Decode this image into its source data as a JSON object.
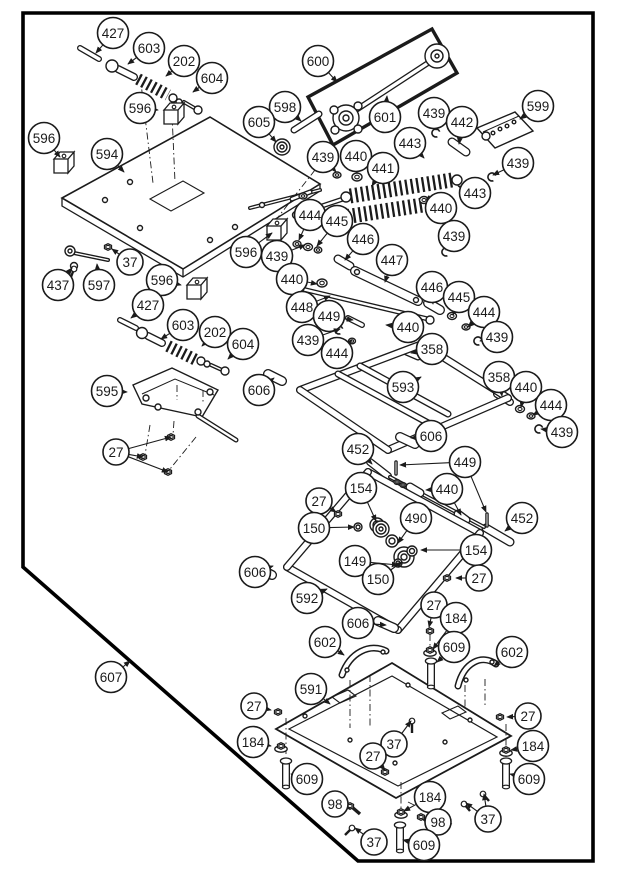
{
  "page": {
    "background": "#ffffff",
    "line_color": "#1b1b1b",
    "frame_color": "#000000"
  },
  "callouts": [
    {
      "label": "427",
      "x": 113,
      "y": 33,
      "targets": [
        [
          96,
          53
        ]
      ]
    },
    {
      "label": "603",
      "x": 149,
      "y": 48,
      "targets": [
        [
          128,
          64
        ]
      ]
    },
    {
      "label": "202",
      "x": 184,
      "y": 61,
      "targets": [
        [
          166,
          76
        ]
      ]
    },
    {
      "label": "604",
      "x": 212,
      "y": 78,
      "targets": [
        [
          193,
          92
        ]
      ]
    },
    {
      "label": "596",
      "x": 140,
      "y": 108,
      "targets": [
        [
          158,
          110
        ]
      ]
    },
    {
      "label": "598",
      "x": 285,
      "y": 107,
      "targets": [
        [
          301,
          121
        ]
      ]
    },
    {
      "label": "605",
      "x": 259,
      "y": 122,
      "targets": [
        [
          276,
          142
        ]
      ]
    },
    {
      "label": "600",
      "x": 318,
      "y": 61,
      "targets": [
        [
          337,
          82
        ]
      ]
    },
    {
      "label": "601",
      "x": 385,
      "y": 117,
      "targets": [
        [
          387,
          96
        ]
      ]
    },
    {
      "label": "439",
      "x": 434,
      "y": 113,
      "targets": [
        [
          436,
          130
        ]
      ]
    },
    {
      "label": "442",
      "x": 462,
      "y": 122,
      "targets": [
        [
          459,
          144
        ]
      ]
    },
    {
      "label": "599",
      "x": 538,
      "y": 106,
      "targets": [
        [
          520,
          119
        ]
      ]
    },
    {
      "label": "596",
      "x": 44,
      "y": 138,
      "targets": [
        [
          60,
          157
        ]
      ]
    },
    {
      "label": "594",
      "x": 107,
      "y": 154,
      "targets": [
        [
          124,
          172
        ]
      ]
    },
    {
      "label": "443",
      "x": 410,
      "y": 143,
      "targets": [
        [
          424,
          158
        ]
      ]
    },
    {
      "label": "439",
      "x": 323,
      "y": 157,
      "targets": [
        [
          336,
          172
        ]
      ]
    },
    {
      "label": "440",
      "x": 356,
      "y": 156,
      "targets": [
        [
          357,
          173
        ]
      ]
    },
    {
      "label": "441",
      "x": 383,
      "y": 168,
      "targets": [
        [
          372,
          186
        ]
      ]
    },
    {
      "label": "439",
      "x": 518,
      "y": 163,
      "targets": [
        [
          493,
          175
        ]
      ]
    },
    {
      "label": "443",
      "x": 475,
      "y": 193,
      "targets": [
        [
          458,
          186
        ]
      ]
    },
    {
      "label": "440",
      "x": 441,
      "y": 208,
      "targets": [
        [
          432,
          201
        ]
      ]
    },
    {
      "label": "444",
      "x": 310,
      "y": 215,
      "targets": [
        [
          299,
          240
        ]
      ]
    },
    {
      "label": "445",
      "x": 337,
      "y": 221,
      "targets": [
        [
          317,
          246
        ]
      ]
    },
    {
      "label": "446",
      "x": 363,
      "y": 239,
      "targets": [
        [
          345,
          260
        ]
      ]
    },
    {
      "label": "447",
      "x": 392,
      "y": 260,
      "targets": [
        [
          385,
          282
        ]
      ]
    },
    {
      "label": "439",
      "x": 454,
      "y": 236,
      "targets": [
        [
          446,
          250
        ]
      ]
    },
    {
      "label": "446",
      "x": 432,
      "y": 287,
      "targets": [
        [
          433,
          304
        ]
      ]
    },
    {
      "label": "445",
      "x": 459,
      "y": 297,
      "targets": [
        [
          453,
          315
        ]
      ]
    },
    {
      "label": "444",
      "x": 484,
      "y": 312,
      "targets": [
        [
          468,
          327
        ]
      ]
    },
    {
      "label": "439",
      "x": 497,
      "y": 337,
      "targets": [
        [
          480,
          341
        ]
      ]
    },
    {
      "label": "596",
      "x": 246,
      "y": 252,
      "targets": [
        [
          272,
          233
        ]
      ]
    },
    {
      "label": "439",
      "x": 277,
      "y": 256,
      "targets": [
        [
          305,
          245
        ]
      ]
    },
    {
      "label": "37",
      "x": 130,
      "y": 262,
      "targets": [
        [
          112,
          249
        ]
      ]
    },
    {
      "label": "437",
      "x": 58,
      "y": 285,
      "targets": [
        [
          72,
          268
        ]
      ]
    },
    {
      "label": "597",
      "x": 99,
      "y": 285,
      "targets": [
        [
          97,
          264
        ]
      ]
    },
    {
      "label": "596",
      "x": 162,
      "y": 280,
      "targets": [
        [
          181,
          285
        ]
      ]
    },
    {
      "label": "440",
      "x": 292,
      "y": 279,
      "targets": [
        [
          317,
          284
        ]
      ]
    },
    {
      "label": "448",
      "x": 302,
      "y": 307,
      "targets": [
        [
          330,
          296
        ]
      ]
    },
    {
      "label": "449",
      "x": 329,
      "y": 316,
      "targets": [
        [
          353,
          320
        ]
      ]
    },
    {
      "label": "439",
      "x": 308,
      "y": 340,
      "targets": [
        [
          340,
          329
        ]
      ]
    },
    {
      "label": "444",
      "x": 337,
      "y": 353,
      "targets": [
        [
          352,
          340
        ]
      ]
    },
    {
      "label": "440",
      "x": 408,
      "y": 327,
      "targets": [
        [
          386,
          325
        ]
      ]
    },
    {
      "label": "358",
      "x": 432,
      "y": 349,
      "targets": [
        [
          411,
          353
        ]
      ]
    },
    {
      "label": "427",
      "x": 148,
      "y": 305,
      "targets": [
        [
          131,
          318
        ]
      ]
    },
    {
      "label": "603",
      "x": 183,
      "y": 325,
      "targets": [
        [
          161,
          339
        ]
      ]
    },
    {
      "label": "202",
      "x": 215,
      "y": 332,
      "targets": [
        [
          202,
          346
        ]
      ]
    },
    {
      "label": "604",
      "x": 243,
      "y": 344,
      "targets": [
        [
          228,
          359
        ]
      ]
    },
    {
      "label": "358",
      "x": 499,
      "y": 377,
      "targets": [
        [
          502,
          396
        ]
      ]
    },
    {
      "label": "440",
      "x": 526,
      "y": 387,
      "targets": [
        [
          521,
          407
        ]
      ]
    },
    {
      "label": "444",
      "x": 551,
      "y": 405,
      "targets": [
        [
          533,
          415
        ]
      ]
    },
    {
      "label": "439",
      "x": 562,
      "y": 432,
      "targets": [
        [
          541,
          429
        ]
      ]
    },
    {
      "label": "593",
      "x": 403,
      "y": 387,
      "targets": [
        [
          421,
          377
        ]
      ]
    },
    {
      "label": "595",
      "x": 107,
      "y": 391,
      "targets": [
        [
          127,
          392
        ]
      ]
    },
    {
      "label": "606",
      "x": 259,
      "y": 390,
      "targets": [
        [
          274,
          378
        ]
      ]
    },
    {
      "label": "606",
      "x": 431,
      "y": 436,
      "targets": [
        [
          411,
          438
        ]
      ]
    },
    {
      "label": "27",
      "x": 116,
      "y": 452,
      "targets": [
        [
          171,
          437
        ],
        [
          143,
          457
        ],
        [
          168,
          472
        ]
      ]
    },
    {
      "label": "452",
      "x": 358,
      "y": 449,
      "targets": [
        [
          372,
          464
        ]
      ]
    },
    {
      "label": "449",
      "x": 465,
      "y": 462,
      "targets": [
        [
          400,
          465
        ],
        [
          486,
          512
        ]
      ]
    },
    {
      "label": "154",
      "x": 361,
      "y": 488,
      "targets": [
        [
          376,
          521
        ]
      ]
    },
    {
      "label": "440",
      "x": 447,
      "y": 489,
      "targets": [
        [
          426,
          490
        ],
        [
          461,
          515
        ]
      ]
    },
    {
      "label": "27",
      "x": 319,
      "y": 501,
      "targets": [
        [
          336,
          512
        ]
      ]
    },
    {
      "label": "490",
      "x": 416,
      "y": 518,
      "targets": [
        [
          398,
          543
        ]
      ]
    },
    {
      "label": "452",
      "x": 522,
      "y": 518,
      "targets": [
        [
          505,
          531
        ]
      ]
    },
    {
      "label": "150",
      "x": 314,
      "y": 528,
      "targets": [
        [
          354,
          527
        ]
      ]
    },
    {
      "label": "154",
      "x": 476,
      "y": 550,
      "targets": [
        [
          421,
          550
        ]
      ]
    },
    {
      "label": "149",
      "x": 355,
      "y": 561,
      "targets": [
        [
          398,
          565
        ]
      ]
    },
    {
      "label": "606",
      "x": 255,
      "y": 572,
      "targets": [
        [
          273,
          566
        ]
      ]
    },
    {
      "label": "150",
      "x": 378,
      "y": 579,
      "targets": [
        [
          402,
          562
        ]
      ]
    },
    {
      "label": "27",
      "x": 479,
      "y": 578,
      "targets": [
        [
          456,
          578
        ]
      ]
    },
    {
      "label": "592",
      "x": 307,
      "y": 598,
      "targets": [
        [
          327,
          589
        ]
      ]
    },
    {
      "label": "606",
      "x": 358,
      "y": 623,
      "targets": [
        [
          386,
          625
        ]
      ]
    },
    {
      "label": "27",
      "x": 434,
      "y": 605,
      "targets": [
        [
          429,
          627
        ]
      ]
    },
    {
      "label": "184",
      "x": 456,
      "y": 618,
      "targets": [
        [
          433,
          649
        ]
      ]
    },
    {
      "label": "609",
      "x": 454,
      "y": 647,
      "targets": [
        [
          437,
          662
        ]
      ]
    },
    {
      "label": "602",
      "x": 325,
      "y": 642,
      "targets": [
        [
          344,
          655
        ]
      ]
    },
    {
      "label": "602",
      "x": 512,
      "y": 652,
      "targets": [
        [
          494,
          666
        ]
      ]
    },
    {
      "label": "591",
      "x": 311,
      "y": 689,
      "targets": [
        [
          330,
          704
        ]
      ]
    },
    {
      "label": "27",
      "x": 254,
      "y": 706,
      "targets": [
        [
          271,
          710
        ]
      ]
    },
    {
      "label": "27",
      "x": 528,
      "y": 716,
      "targets": [
        [
          507,
          717
        ]
      ]
    },
    {
      "label": "184",
      "x": 253,
      "y": 742,
      "targets": [
        [
          271,
          746
        ]
      ]
    },
    {
      "label": "184",
      "x": 533,
      "y": 746,
      "targets": [
        [
          511,
          750
        ]
      ]
    },
    {
      "label": "37",
      "x": 394,
      "y": 744,
      "targets": [
        [
          411,
          721
        ]
      ]
    },
    {
      "label": "27",
      "x": 373,
      "y": 756,
      "targets": [
        [
          385,
          770
        ]
      ]
    },
    {
      "label": "609",
      "x": 307,
      "y": 779,
      "targets": [
        [
          291,
          774
        ]
      ]
    },
    {
      "label": "609",
      "x": 529,
      "y": 779,
      "targets": [
        [
          510,
          774
        ]
      ]
    },
    {
      "label": "98",
      "x": 335,
      "y": 804,
      "targets": [
        [
          350,
          808
        ]
      ]
    },
    {
      "label": "184",
      "x": 430,
      "y": 797,
      "targets": [
        [
          404,
          811
        ]
      ]
    },
    {
      "label": "98",
      "x": 438,
      "y": 822,
      "targets": [
        [
          423,
          819
        ]
      ]
    },
    {
      "label": "37",
      "x": 488,
      "y": 819,
      "targets": [
        [
          466,
          803
        ],
        [
          484,
          794
        ]
      ]
    },
    {
      "label": "37",
      "x": 374,
      "y": 842,
      "targets": [
        [
          355,
          828
        ]
      ]
    },
    {
      "label": "609",
      "x": 424,
      "y": 845,
      "targets": [
        [
          403,
          840
        ]
      ]
    },
    {
      "label": "607",
      "x": 111,
      "y": 677,
      "targets": [
        [
          130,
          661
        ]
      ]
    }
  ]
}
